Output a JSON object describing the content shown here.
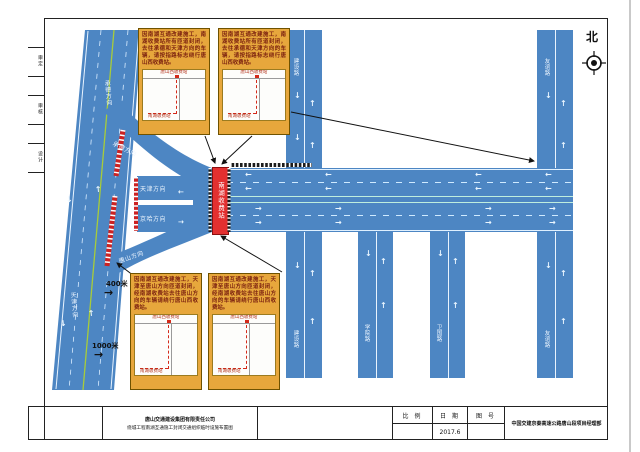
{
  "compass": {
    "north_label": "北"
  },
  "margin_labels": [
    "审定",
    "审核",
    "设计"
  ],
  "mainline": {
    "upper": "承德方向",
    "lower": "天津方向"
  },
  "ramps": {
    "a": "承德方向",
    "b": "天津方向",
    "c": "京哈方向",
    "d": "唐山方向"
  },
  "toll": {
    "name": "南湖收费站"
  },
  "streets": [
    "建设路",
    "学院路",
    "卫国路",
    "友谊路"
  ],
  "distances": {
    "d1": "400米",
    "d2": "1000米"
  },
  "notices": {
    "top_left": {
      "text": "因南湖互通改建施工，南湖收费站所有匝道封闭，去往承德和天津方向的车辆，请按指路标志绕行唐山西收费站。",
      "map": {
        "far_station": "唐山西收费站",
        "near_station": "南湖收费站"
      }
    },
    "top_right": {
      "text": "因南湖互通改建施工，南湖收费站所有匝道封闭，去往承德和天津方向的车辆，请按指路标志绕行唐山西收费站。",
      "map": {
        "far_station": "唐山西收费站",
        "near_station": "南湖收费站"
      }
    },
    "bottom_left": {
      "text": "因南湖互通改建施工，天津至唐山方向匝道封闭，经南湖收费站去往唐山方向的车辆请绕行唐山西收费站。",
      "map": {
        "far_station": "唐山西收费站",
        "near_station": "南湖收费站"
      }
    },
    "bottom_right": {
      "text": "因南湖互通改建施工，天津至唐山方向匝道封闭，经南湖收费站去往唐山方向的车辆请绕行唐山西收费站。",
      "map": {
        "far_station": "唐山西收费站",
        "near_station": "南湖收费站"
      }
    }
  },
  "titleblock": {
    "company": "唐山交通建设集团有限责任公司",
    "drawing_title": "绕城工程南湖互通施工封闭交通组织临时设施布置图",
    "scale_label": "比 例",
    "date_label": "日 期",
    "date_value": "2017.6",
    "no_label": "图 号",
    "org": "中国交建京秦高速公路唐山段项目经理部"
  },
  "icons": {
    "arrow_left": "←",
    "arrow_right": "→",
    "arrow_up": "↑",
    "arrow_down": "↓",
    "dim_arrow": "→",
    "compass": "crosshair-circle"
  },
  "colors": {
    "road_blue": "#4d86c3",
    "notice_yellow": "#e7a73c",
    "notice_text": "#7d2310",
    "toll_red": "#e33030",
    "barrier_red": "#cc2222",
    "center_green": "#a8cc3a"
  }
}
